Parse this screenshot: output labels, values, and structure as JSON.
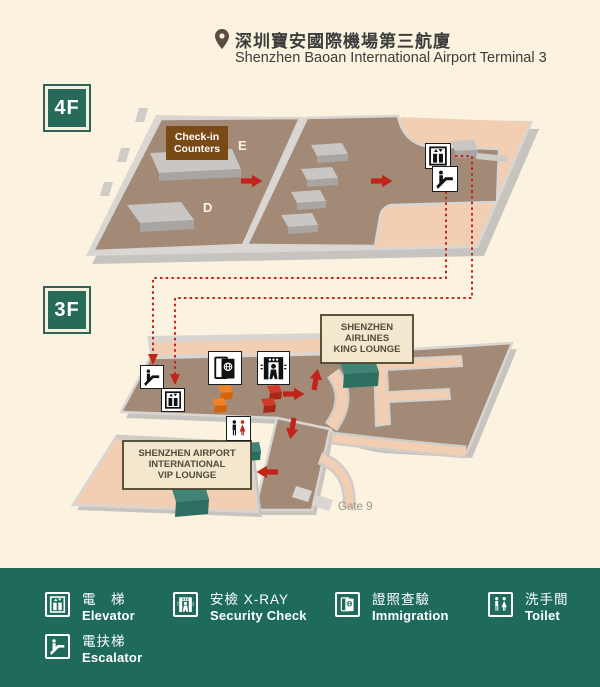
{
  "header": {
    "title_zh": "深圳寶安國際機場第三航廈",
    "title_en": "Shenzhen Baoan International Airport Terminal 3"
  },
  "floor4": {
    "badge": "4F",
    "checkin_line1": "Check-in",
    "checkin_line2": "Counters",
    "zone_e": "E",
    "zone_d": "D"
  },
  "floor3": {
    "badge": "3F",
    "king_lounge": [
      "SHENZHEN",
      "AIRLINES",
      "KING LOUNGE"
    ],
    "vip_lounge": [
      "SHENZHEN AIRPORT",
      "INTERNATIONAL",
      "VIP LOUNGE"
    ],
    "gate": "Gate 9"
  },
  "legend": {
    "elevator": {
      "zh": "電　梯",
      "en": "Elevator"
    },
    "escalator": {
      "zh": "電扶梯",
      "en": "Escalator"
    },
    "security": {
      "zh": "安檢 X-RAY",
      "en": "Security Check"
    },
    "immigration": {
      "zh": "證照查驗",
      "en": "Immigration"
    },
    "toilet": {
      "zh": "洗手間",
      "en": "Toilet"
    }
  },
  "colors": {
    "background": "#fbf2df",
    "legend_bar": "#1e6b5c",
    "badge_teal": "#276a5a",
    "floor_brown": "#a38a77",
    "floor_pink": "#f2cfb3",
    "edge_gray": "#d8d5d2",
    "accent_red": "#c4231b",
    "teal_box": "#3f8475",
    "orange_box": "#f08327",
    "red_box": "#cf3a2a",
    "label_cream": "#f3e8cd",
    "checkin_brown": "#7a4a16"
  }
}
